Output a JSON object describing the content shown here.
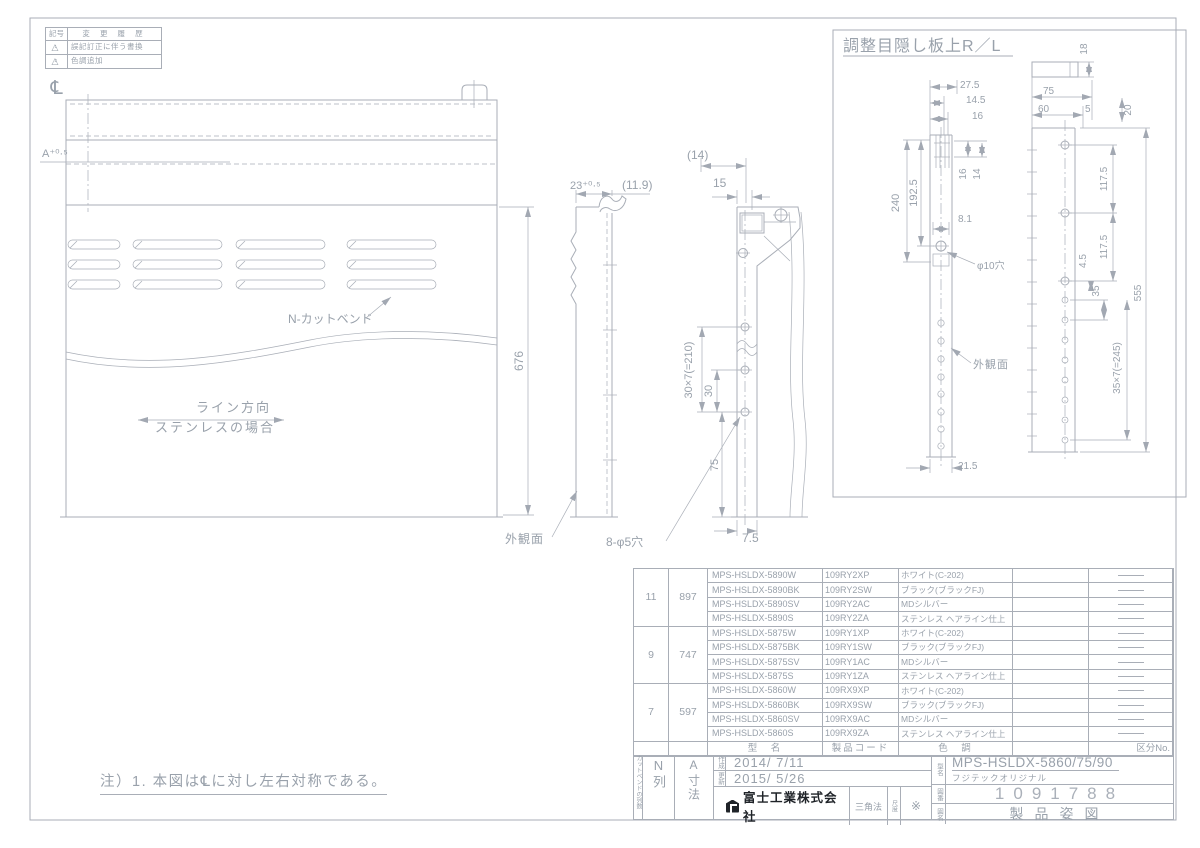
{
  "colors": {
    "line": "#a9aeb7",
    "text": "#99a1ab",
    "dark_text": "#1f2328"
  },
  "revision": {
    "col_symbol": "記号",
    "col_history": "変 更 履 歴",
    "rows": [
      {
        "num": "1",
        "text": "誤記訂正に伴う書換"
      },
      {
        "num": "2",
        "text": "色調追加"
      }
    ]
  },
  "note": "注）1. 本図は℄に対し左右対称である。",
  "dims": {
    "cl": "℄",
    "a_tol": "A⁺⁰·⁵",
    "d676": "676",
    "n_cutbend": "N-カットベンド",
    "line_dir": "ライン方向",
    "stainless": "ステンレスの場合",
    "gaikan": "外観面",
    "d23": "23⁺⁰·⁵",
    "d11_9": "(11.9)",
    "d14p": "(14)",
    "d15": "15",
    "d30x7": "30×7(=210)",
    "d30": "30",
    "d75": "75",
    "d7_5": "7.5",
    "d8phi5": "8-φ5穴",
    "detail_title": "調整目隠し板上R／L",
    "d18": "18",
    "d27_5": "27.5",
    "d14_5": "14.5",
    "d16": "16",
    "d16b": "16",
    "d14": "14",
    "d240": "240",
    "d192_5": "192.5",
    "d8_1": "8.1",
    "phi10": "φ10穴",
    "d117_5a": "117.5",
    "d117_5b": "117.5",
    "d4_5": "4.5",
    "d35": "35",
    "d35x7": "35×7(=245)",
    "d555": "555",
    "d21_5": "21.5",
    "d75t": "75",
    "d60": "60",
    "d5": "5",
    "d20": "20",
    "gaikan2": "外観面"
  },
  "parts_table": {
    "footer": {
      "model": "型　名",
      "code": "製品コード",
      "color": "色　調",
      "kubun": "区分No."
    },
    "groups": [
      {
        "n": "11",
        "a": "897",
        "rows": [
          {
            "mark": "1",
            "model": "MPS-HSLDX-5890W",
            "code": "109RY2XP",
            "color": "ホワイト(C-202)"
          },
          {
            "mark": "2",
            "model": "MPS-HSLDX-5890BK",
            "code": "109RY2SW",
            "color": "ブラック(ブラックFJ)"
          },
          {
            "mark": "",
            "model": "MPS-HSLDX-5890SV",
            "code": "109RY2AC",
            "color": "MDシルバー"
          },
          {
            "mark": "",
            "model": "MPS-HSLDX-5890S",
            "code": "109RY2ZA",
            "color": "ステンレス ヘアライン仕上"
          }
        ]
      },
      {
        "n": "9",
        "a": "747",
        "rows": [
          {
            "mark": "1",
            "model": "MPS-HSLDX-5875W",
            "code": "109RY1XP",
            "color": "ホワイト(C-202)"
          },
          {
            "mark": "2",
            "model": "MPS-HSLDX-5875BK",
            "code": "109RY1SW",
            "color": "ブラック(ブラックFJ)"
          },
          {
            "mark": "",
            "model": "MPS-HSLDX-5875SV",
            "code": "109RY1AC",
            "color": "MDシルバー"
          },
          {
            "mark": "",
            "model": "MPS-HSLDX-5875S",
            "code": "109RY1ZA",
            "color": "ステンレス ヘアライン仕上"
          }
        ]
      },
      {
        "n": "7",
        "a": "597",
        "rows": [
          {
            "mark": "1",
            "model": "MPS-HSLDX-5860W",
            "code": "109RX9XP",
            "color": "ホワイト(C-202)"
          },
          {
            "mark": "2",
            "model": "MPS-HSLDX-5860BK",
            "code": "109RX9SW",
            "color": "ブラック(ブラックFJ)"
          },
          {
            "mark": "",
            "model": "MPS-HSLDX-5860SV",
            "code": "109RX9AC",
            "color": "MDシルバー"
          },
          {
            "mark": "",
            "model": "MPS-HSLDX-5860S",
            "code": "109RX9ZA",
            "color": "ステンレス ヘアライン仕上"
          }
        ]
      }
    ]
  },
  "titleblock": {
    "col_note": "カットベンドの列数",
    "n_col": "N列",
    "a_col": "A寸法",
    "created_label": "作成",
    "created": "2014/ 7/11",
    "updated_label": "更新",
    "updated": "2015/ 5/26",
    "company": "富士工業株式会社",
    "method": "三角法",
    "scale_label": "尺度",
    "scale_value": "※",
    "model_label": "型名",
    "model": "MPS-HSLDX-5860/75/90",
    "model_sub": "フジテックオリジナル",
    "dwgno_label": "図番",
    "dwgno": "1091788",
    "name_label": "図名",
    "name": "製品姿図"
  }
}
